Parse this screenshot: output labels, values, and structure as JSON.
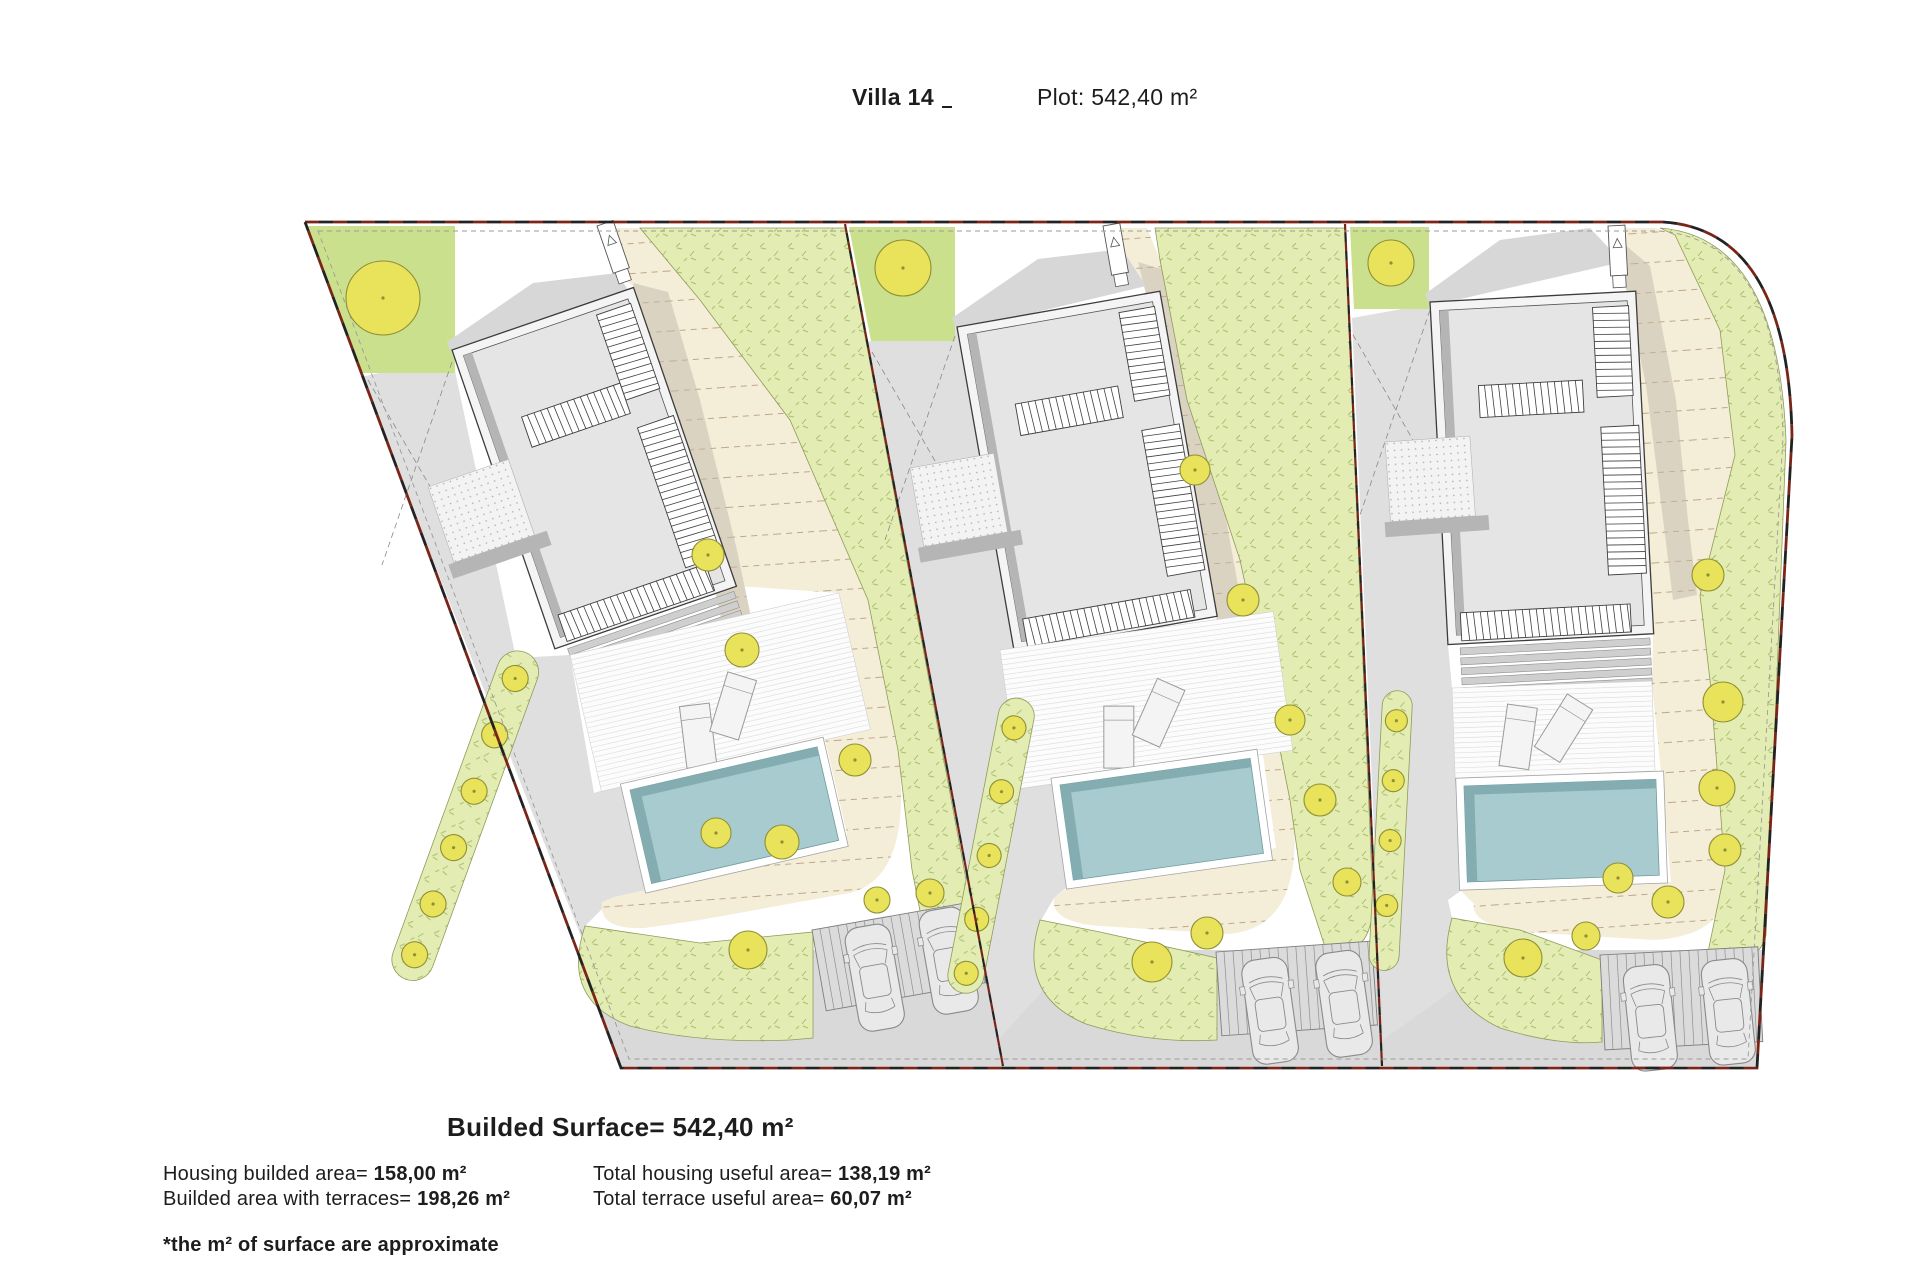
{
  "header": {
    "title": "Villa 14",
    "plot_label": "Plot: 542,40 m²"
  },
  "summary": {
    "main_title": "Builded Surface= 542,40 m²",
    "rows": [
      {
        "label": "Housing builded area= ",
        "value": "158,00 m²"
      },
      {
        "label": "Builded area with terraces= ",
        "value": "198,26 m²"
      },
      {
        "label": "Total housing useful area= ",
        "value": "138,19 m²"
      },
      {
        "label": "Total terrace useful area= ",
        "value": "60,07 m²"
      }
    ],
    "footnote": "*the m² of surface are approximate"
  },
  "plan": {
    "villa_count": 3,
    "features": [
      "site-boundary",
      "plot-dividers",
      "villa-building",
      "roof-terrace-louvers",
      "terrace-steps",
      "wood-deck",
      "sun-loungers",
      "swimming-pool",
      "garden-patch",
      "grass-bands",
      "trees",
      "gravel-path",
      "parking-pad",
      "cars",
      "road"
    ],
    "colors": {
      "boundary_red": "#7a2518",
      "boundary_black": "#222222",
      "inner_line": "#9b9b9b",
      "road": "#d9d9da",
      "drive": "#dfdfe0",
      "building_wall": "#f4f4f4",
      "building_fill": "#e5e5e5",
      "building_stroke": "#3c3c3c",
      "building_shadow": "#b5b5b5",
      "roof_ext": "#d7d7d7",
      "step_fill": "#cfcfcf",
      "step_line": "#8f8f8f",
      "deck_bg": "#fcfcfc",
      "deck_line": "#e0e0e0",
      "lounger": "#f4f4f4",
      "lounger_stroke": "#9a9a9a",
      "pool": "#a7cbce",
      "pool_dark": "#84adb2",
      "pool_border": "#ffffff",
      "cream": "#f4eed8",
      "cream_line": "#b99f80",
      "tan": "#dbd3c2",
      "grass": "#e3ecb2",
      "grass_mark": "#9fb763",
      "grass_stroke": "#8f9b5a",
      "garden": "#cbe08c",
      "tree_fill": "#e9e25b",
      "tree_stroke": "#8f8f35",
      "dots_bg": "#f3f3f3",
      "dot": "#ababab",
      "park_bg": "#dbdbdb",
      "park_line": "#8f8f8f",
      "car_stroke": "#8a8a8a",
      "car_fill": "#e9e9e9",
      "hatch_stroke": "#3f3f3f"
    }
  }
}
